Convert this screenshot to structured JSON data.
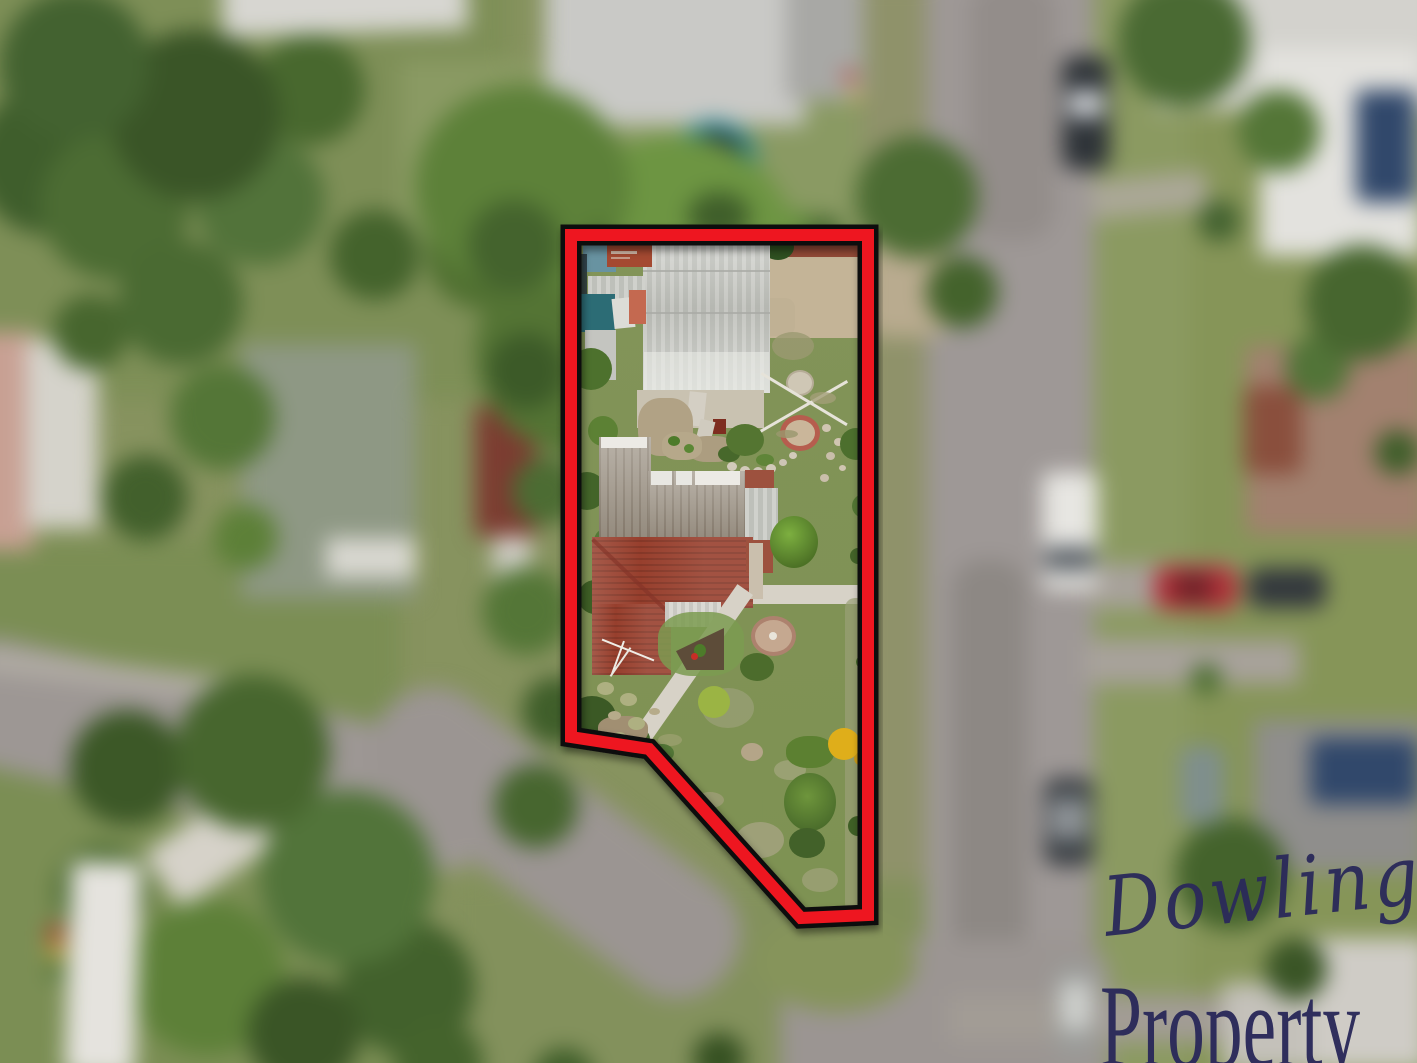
{
  "watermark": {
    "script_text": "Dowling",
    "serif_text": "Property",
    "color": "#2b2a5a"
  },
  "boundary": {
    "line_color": "#ee1620",
    "halo_color": "#111111"
  },
  "scene": {
    "type": "aerial-drone-photo",
    "focus": "suburban property highlighted with red boundary outline, surroundings blurred",
    "colors": {
      "grass": "#84955c",
      "road": "#9d9795",
      "shed_roof": "#c8c9c4",
      "weathered_roof": "#9b9184",
      "tile_roof": "#93402f",
      "teal_tarp": "#2f6b74",
      "trampoline_ring": "#2f8c92",
      "solar_panels": "#31486b",
      "dirt": "#c3b499"
    }
  }
}
